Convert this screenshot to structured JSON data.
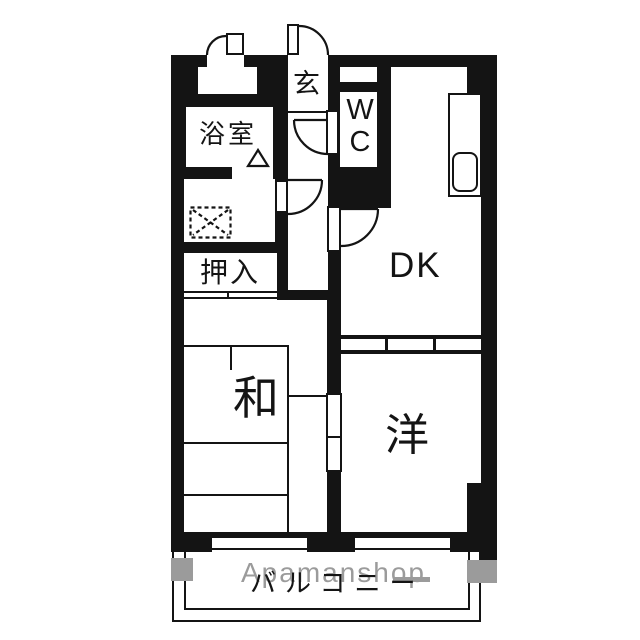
{
  "title": "apartment-floorplan",
  "labels": {
    "genkan": "玄",
    "bathroom": "浴室",
    "closet": "押入",
    "wc": "WC",
    "dining_kitchen": "DK",
    "japanese_room": "和",
    "western_room": "洋",
    "balcony": "バルコニー",
    "watermark": "Apamanshop"
  },
  "colors": {
    "line": "#141414",
    "watermark": "#9b9b9b",
    "background": "#ffffff"
  }
}
